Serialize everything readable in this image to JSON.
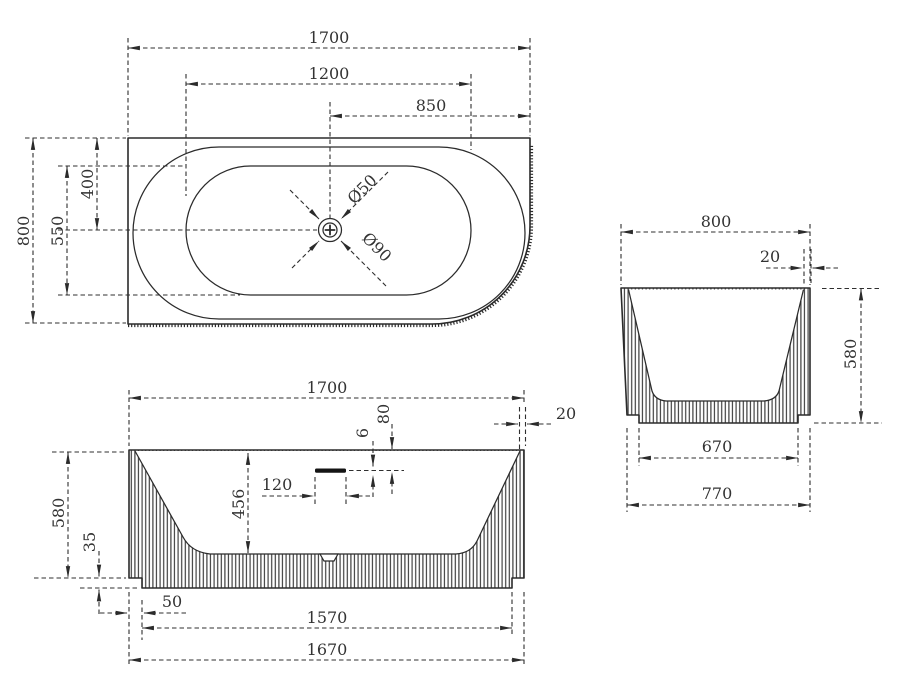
{
  "drawing": {
    "background": "#ffffff",
    "line_color": "#2b2b2b",
    "views": {
      "plan": {
        "dims": {
          "overall_length": "1700",
          "basin_length": "1200",
          "drain_to_end": "850",
          "overall_width": "800",
          "basin_width": "550",
          "back_to_drain": "400",
          "drain_diameter": "Ø50",
          "drain_flange_diameter": "Ø90"
        }
      },
      "front": {
        "dims": {
          "overall_length": "1700",
          "rim_thickness": "20",
          "rim_to_overflow": "80",
          "overflow_slot_height": "6",
          "overflow_width": "120",
          "basin_depth": "456",
          "overall_height": "580",
          "base_recess_height": "35",
          "base_inset": "50",
          "base_length": "1570",
          "shell_bottom_length": "1670"
        }
      },
      "side": {
        "dims": {
          "overall_width": "800",
          "rim_thickness": "20",
          "overall_height": "580",
          "base_width": "670",
          "shell_bottom_width": "770"
        }
      }
    }
  }
}
